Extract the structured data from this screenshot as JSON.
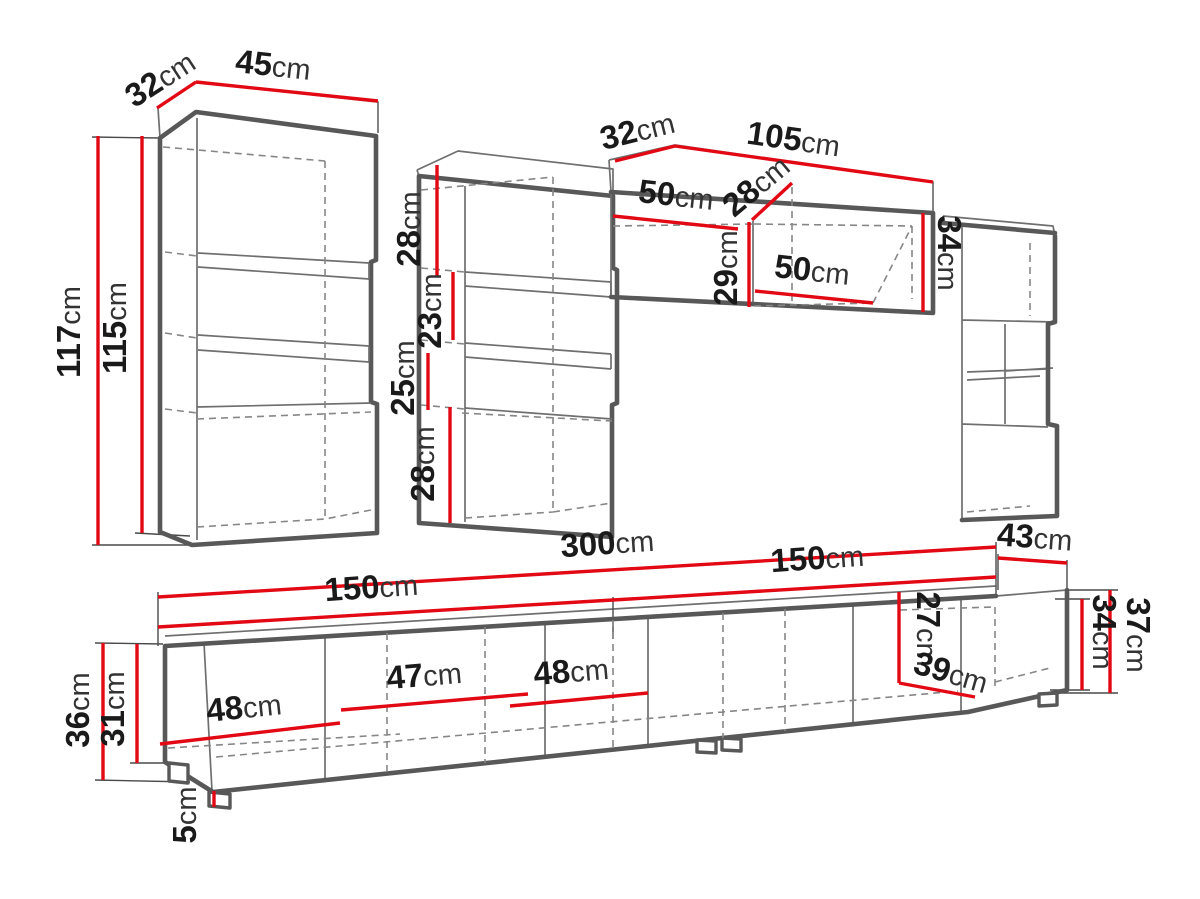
{
  "units": "cm",
  "colors": {
    "dimension_red": "#e30914",
    "outline_gray": "#585858",
    "dashed_gray": "#868686",
    "text_black": "#1a1a1a",
    "background": "#ffffff"
  },
  "labels": {
    "lc_depth": {
      "num": "32",
      "unit": "cm"
    },
    "lc_width": {
      "num": "45",
      "unit": "cm"
    },
    "lc_height": {
      "num": "117",
      "unit": "cm"
    },
    "lc_inner_height": {
      "num": "115",
      "unit": "cm"
    },
    "mc_s1": {
      "num": "28",
      "unit": "cm"
    },
    "mc_s2": {
      "num": "23",
      "unit": "cm"
    },
    "mc_s3": {
      "num": "25",
      "unit": "cm"
    },
    "mc_s4": {
      "num": "28",
      "unit": "cm"
    },
    "br_depth": {
      "num": "32",
      "unit": "cm"
    },
    "br_width": {
      "num": "105",
      "unit": "cm"
    },
    "br_open_top_w": {
      "num": "50",
      "unit": "cm"
    },
    "br_open_depth": {
      "num": "28",
      "unit": "cm"
    },
    "br_open_height": {
      "num": "29",
      "unit": "cm"
    },
    "br_open_bot_w": {
      "num": "50",
      "unit": "cm"
    },
    "br_height": {
      "num": "34",
      "unit": "cm"
    },
    "ts_total_width": {
      "num": "300",
      "unit": "cm"
    },
    "ts_left_half": {
      "num": "150",
      "unit": "cm"
    },
    "ts_right_half": {
      "num": "150",
      "unit": "cm"
    },
    "ts_depth": {
      "num": "43",
      "unit": "cm"
    },
    "ts_height_left": {
      "num": "36",
      "unit": "cm"
    },
    "ts_inner_left": {
      "num": "31",
      "unit": "cm"
    },
    "ts_door1": {
      "num": "48",
      "unit": "cm"
    },
    "ts_door2": {
      "num": "47",
      "unit": "cm"
    },
    "ts_door3": {
      "num": "48",
      "unit": "cm"
    },
    "ts_inner_right": {
      "num": "27",
      "unit": "cm"
    },
    "ts_bottom_depth": {
      "num": "39",
      "unit": "cm"
    },
    "ts_height_right": {
      "num": "37",
      "unit": "cm"
    },
    "ts_inner_right2": {
      "num": "34",
      "unit": "cm"
    },
    "ts_leg_height": {
      "num": "5",
      "unit": "cm"
    }
  }
}
